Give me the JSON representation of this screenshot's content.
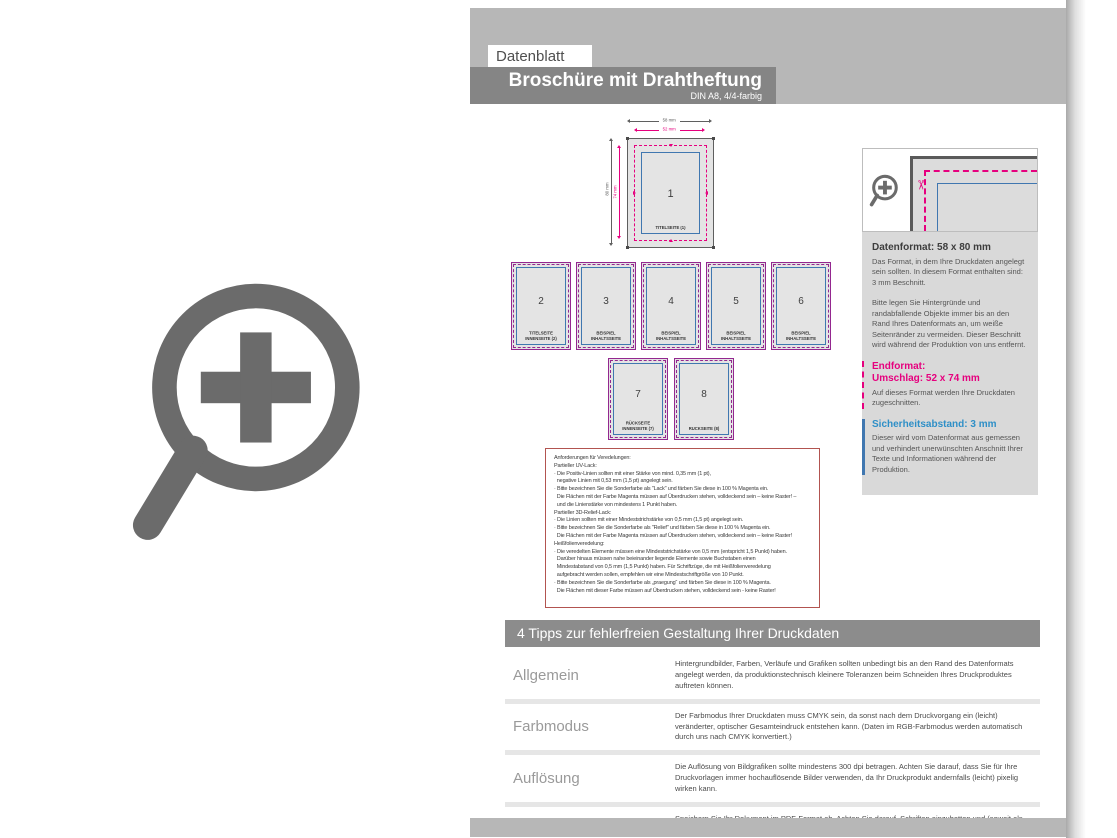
{
  "header": {
    "datenblatt_label": "Datenblatt",
    "title": "Broschüre mit Drahtheftung",
    "subtitle": "DIN A8, 4/4-farbig"
  },
  "colors": {
    "magenta_cutline": "#e6007e",
    "blue_safety": "#4077b0",
    "purple_pageborder": "#93278f",
    "gray_band": "#b7b7b7",
    "gray_titlebar": "#858585"
  },
  "icons": {
    "scissors_glyph": "✂",
    "zoom_plus": "zoom-plus-icon"
  },
  "diagram": {
    "dims": {
      "outer_width": "58 mm",
      "inner_width": "52 mm",
      "outer_height": "80 mm",
      "inner_height": "74 mm"
    },
    "pages": [
      {
        "number": "1",
        "label": "TITELSEITE (1)"
      },
      {
        "number": "2",
        "label": "TITELSEITE\nINNENSEITE (2)"
      },
      {
        "number": "3",
        "label": "BEISPIEL INHALTSSEITE"
      },
      {
        "number": "4",
        "label": "BEISPIEL INHALTSSEITE"
      },
      {
        "number": "5",
        "label": "BEISPIEL INHALTSSEITE"
      },
      {
        "number": "6",
        "label": "BEISPIEL INHALTSSEITE"
      },
      {
        "number": "7",
        "label": "RÜCKSEITE\nINNENSEITE (7)"
      },
      {
        "number": "8",
        "label": "RÜCKSEITE (8)"
      }
    ]
  },
  "requirements": {
    "lines": [
      "Anforderungen für Veredelungen:",
      "Partieller UV-Lack:",
      "· Die Positiv-Linien sollten mit einer Stärke von mind. 0,35 mm (1 pt),",
      "  negative Linien mit 0,53 mm (1,5 pt) angelegt sein.",
      "· Bitte bezeichnen Sie die Sonderfarbe als \"Lack\" und färben Sie diese in 100 % Magenta ein.",
      "  Die Flächen mit der Farbe Magenta müssen auf Überdrucken stehen, volldeckend sein – keine Raster! –",
      "  und die Linienstärke von mindestens 1 Punkt haben.",
      "Partieller 3D-Relief-Lack:",
      "· Die Linien sollten mit einer Mindeststrichstärke von 0,5 mm (1,5 pt) angelegt sein.",
      "· Bitte bezeichnen Sie die Sonderfarbe als \"Relief\" und färben Sie diese in 100 % Magenta ein.",
      "  Die Flächen mit der Farbe Magenta müssen auf Überdrucken stehen, volldeckend sein – keine Raster!",
      "Heißfolienveredelung:",
      "· Die veredelten Elemente müssen eine Mindeststrichstärke von 0,5 mm (entspricht 1,5 Punkt) haben.",
      "  Darüber hinaus müssen nahe beieinander liegende Elemente sowie Buchstaben einen",
      "  Mindestabstand von 0,5 mm (1,5 Punkt) haben. Für Schriftzüge, die mit Heißfolienveredelung",
      "  aufgebracht werden sollen, empfehlen wir eine Mindestschriftgröße von 10 Punkt.",
      "· Bitte bezeichnen Sie die Sonderfarbe als „praegung“ und färben Sie diese in 100 % Magenta.",
      "  Die Flächen mit dieser Farbe müssen auf Überdrucken stehen, volldeckend sein - keine Raster!"
    ]
  },
  "sidebar": {
    "datenformat_title": "Datenformat: 58 x 80 mm",
    "datenformat_text": "Das Format, in dem Ihre Druckdaten angelegt sein sollten. In diesem Format enthalten sind: 3 mm Beschnitt.",
    "bleed_text": "Bitte legen Sie Hintergründe und randabfallende Objekte immer bis an den Rand Ihres Datenformats an, um weiße Seitenränder zu vermeiden. Dieser Beschnitt wird während der Produktion von uns entfernt.",
    "endformat_title": "Endformat:",
    "endformat_subtitle": "Umschlag: 52 x 74 mm",
    "endformat_text": "Auf dieses Format werden Ihre Druckdaten zugeschnitten.",
    "safety_title": "Sicherheitsabstand: 3 mm",
    "safety_text": "Dieser wird vom Datenformat aus gemessen und verhindert unerwünschten Anschnitt Ihrer Texte und Informationen während der Produktion."
  },
  "tips": {
    "header": "4 Tipps zur fehlerfreien Gestaltung Ihrer Druckdaten",
    "rows": [
      {
        "label": "Allgemein",
        "text": "Hintergrundbilder, Farben, Verläufe und Grafiken sollten unbedingt bis an den Rand des Datenformats angelegt werden, da produktionstechnisch kleinere Toleranzen beim Schneiden Ihres Druckproduktes auftreten können."
      },
      {
        "label": "Farbmodus",
        "text": "Der Farbmodus Ihrer Druckdaten muss CMYK sein, da sonst nach dem Druckvorgang ein (leicht) veränderter, optischer Gesamteindruck entstehen kann. (Daten im RGB-Farbmodus werden automatisch durch uns nach CMYK konvertiert.)"
      },
      {
        "label": "Auflösung",
        "text": "Die Auflösung von Bildgrafiken sollte mindestens 300 dpi betragen. Achten Sie darauf, dass Sie für Ihre Druckvorlagen immer hochauflösende Bilder verwenden, da Ihr Druckprodukt andernfalls (leicht) pixelig wirken kann."
      },
      {
        "label": "Dateiformat",
        "text": "Speichern Sie Ihr Dokument im PDF-Format ab. Achten Sie darauf, Schriften einzubetten und (soweit als möglich) Transparenzen zu reduzieren."
      }
    ]
  }
}
